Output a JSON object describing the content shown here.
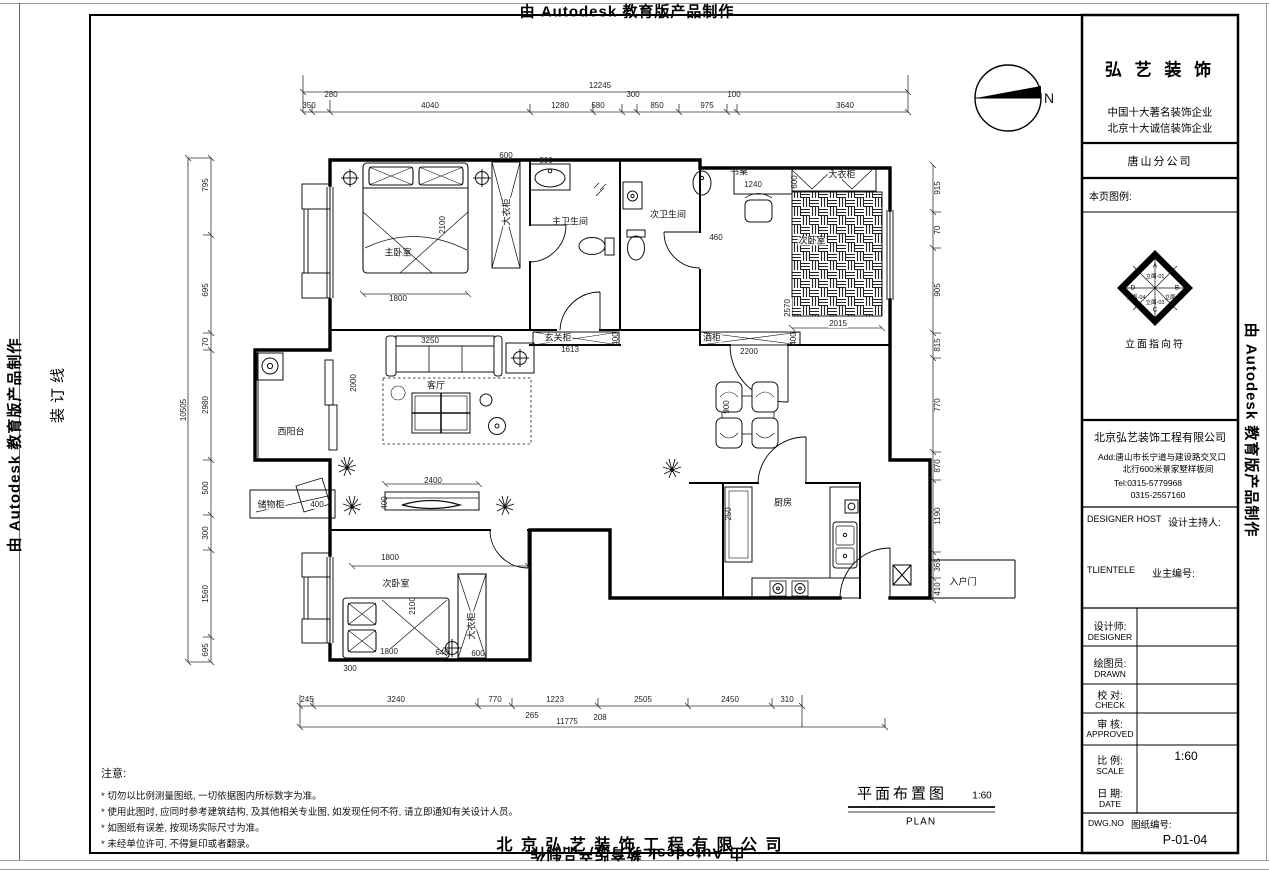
{
  "watermark": "由 Autodesk 教育版产品制作",
  "binding_line": "装订线",
  "compass": {
    "label": "N"
  },
  "title_block": {
    "brand": "弘 艺 装 饰",
    "slogan1": "中国十大著名装饰企业",
    "slogan2": "北京十大诚信装饰企业",
    "branch": "唐山分公司",
    "legend_label": "本页图例:",
    "elevation_symbol": {
      "top": "A",
      "right": "B",
      "bottom": "C",
      "left": "D",
      "e1": "立面-01",
      "e2": "立面-02",
      "e3": "立面-03",
      "e4": "立面-04",
      "caption": "立面指向符"
    },
    "company": "北京弘艺装饰工程有限公司",
    "address1": "Add:唐山市长宁道与建设路交叉口",
    "address2": "北行600米景家墅样板间",
    "tel1": "Tel:0315-5779968",
    "tel2": "0315-2557160",
    "designer_host_en": "DESIGNER HOST",
    "designer_host_cn": "设计主持人:",
    "clientele_en": "TLIENTELE",
    "clientele_cn": "业主编号:",
    "rows": [
      {
        "cn": "设计师:",
        "en": "DESIGNER",
        "value": ""
      },
      {
        "cn": "绘图员:",
        "en": "DRAWN",
        "value": ""
      },
      {
        "cn": "校 对:",
        "en": "CHECK",
        "value": ""
      },
      {
        "cn": "审 核:",
        "en": "APPROVED",
        "value": ""
      },
      {
        "cn": "比 例:",
        "en": "SCALE",
        "value": "1:60"
      },
      {
        "cn": "日 期:",
        "en": "DATE",
        "value": ""
      }
    ],
    "dwg_label_en": "DWG.NO",
    "dwg_label_cn": "图纸编号:",
    "dwg_no": "P-01-04"
  },
  "notes": {
    "title": "注意:",
    "items": [
      "* 切勿以比例测量图纸, 一切依据图内所标数字为准。",
      "* 使用此图时, 应同时参考建筑结构, 及其他相关专业图, 如发现任何不符, 请立即通知有关设计人员。",
      "* 如图纸有误差, 按现场实际尺寸为准。",
      "* 未经单位许可, 不得复印或者翻录。"
    ]
  },
  "footer": {
    "drawing_title": "平面布置图",
    "drawing_scale": "1:60",
    "drawing_title_en": "PLAN",
    "company": "北 京 弘 艺 装 饰 工 程 有 限 公 司"
  },
  "plan": {
    "labels": [
      "主卧室",
      "1800",
      "2100",
      "600",
      "大衣柜",
      "800",
      "主卫生间",
      "次卫生间",
      "书桌",
      "1240",
      "大衣柜",
      "600",
      "次卧室",
      "2570",
      "2015",
      "玄关柜",
      "1613",
      "400",
      "酒柜",
      "2200",
      "400",
      "客厅",
      "3250",
      "2000",
      "西阳台",
      "2400",
      "400",
      "储物柜",
      "400",
      "次卧室",
      "1800",
      "2100",
      "1800",
      "640",
      "600",
      "大衣柜",
      "300",
      "900",
      "入户门",
      "厨房",
      "460",
      "265",
      "208",
      "250"
    ],
    "dims": {
      "top": {
        "total": "12245",
        "segments": [
          "350",
          "280",
          "4040",
          "1280",
          "580",
          "300",
          "850",
          "975",
          "100",
          "3640"
        ]
      },
      "bottom": {
        "total": "11775",
        "segments": [
          "245",
          "3240",
          "770",
          "1223",
          "2505",
          "2450",
          "310"
        ]
      },
      "left": {
        "total": "10505",
        "segments": [
          "795",
          "695",
          "70",
          "2980",
          "500",
          "300",
          "1560",
          "695"
        ]
      },
      "right": {
        "segments": [
          "915",
          "70",
          "905",
          "815",
          "770",
          "870",
          "1190",
          "365",
          "410"
        ]
      }
    }
  }
}
